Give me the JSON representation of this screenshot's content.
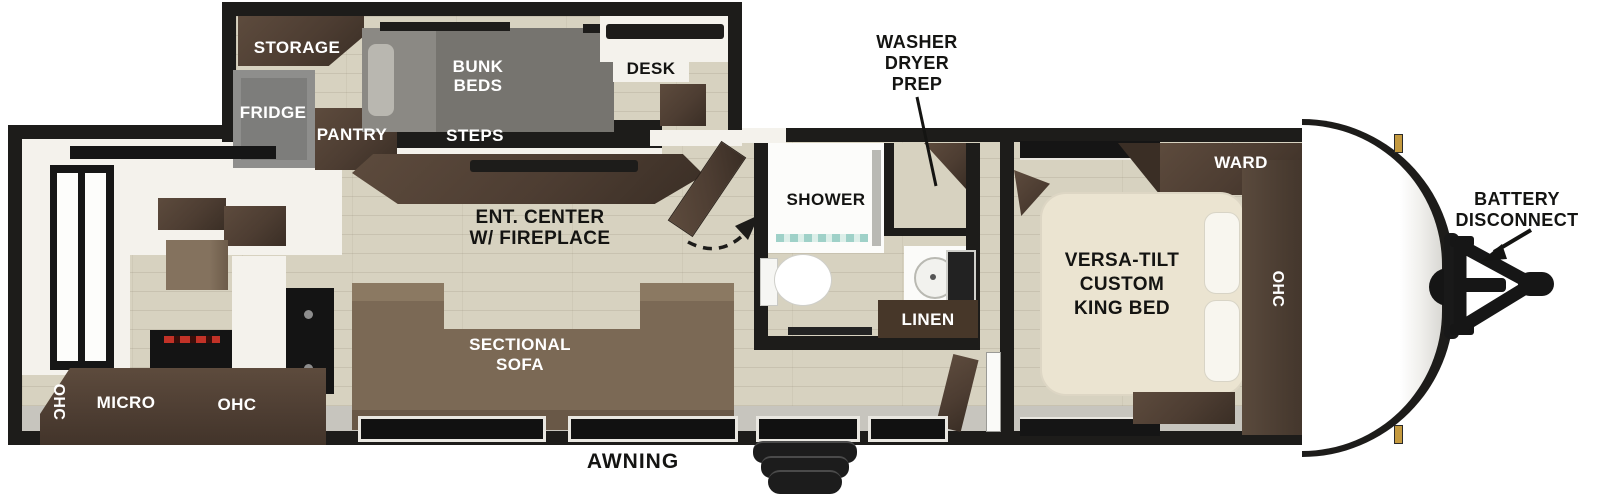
{
  "diagram": {
    "type": "travel-trailer-floor-plan",
    "labels": {
      "storage": "STORAGE",
      "fridge": "FRIDGE",
      "pantry": "PANTRY",
      "bunk_beds": [
        "BUNK",
        "BEDS"
      ],
      "steps": "STEPS",
      "desk": "DESK",
      "washer_dryer_prep": [
        "WASHER",
        "DRYER",
        "PREP"
      ],
      "shower": "SHOWER",
      "linen": "LINEN",
      "ward": "WARD",
      "ohc_left": "OHC",
      "micro": "MICRO",
      "ohc_kitchen": "OHC",
      "ohc_bedroom": "OHC",
      "ent_center": [
        "ENT. CENTER",
        "W/ FIREPLACE"
      ],
      "sectional_sofa": [
        "SECTIONAL",
        "SOFA"
      ],
      "king_bed": [
        "VERSA-TILT",
        "CUSTOM",
        "KING BED"
      ],
      "battery_disconnect": [
        "BATTERY",
        "DISCONNECT"
      ],
      "awning": "AWNING"
    },
    "colors": {
      "wall": "#1d1c1a",
      "floor": "#d7d2c0",
      "cab": "#4d3d32",
      "sofa": "#7b6955",
      "bunk": "#8b8984",
      "fridge": "#8e8e8c",
      "bed": "#ebe4d1",
      "gold": "#c59a3f",
      "txt": "#ffffff",
      "ink": "#141412"
    }
  }
}
